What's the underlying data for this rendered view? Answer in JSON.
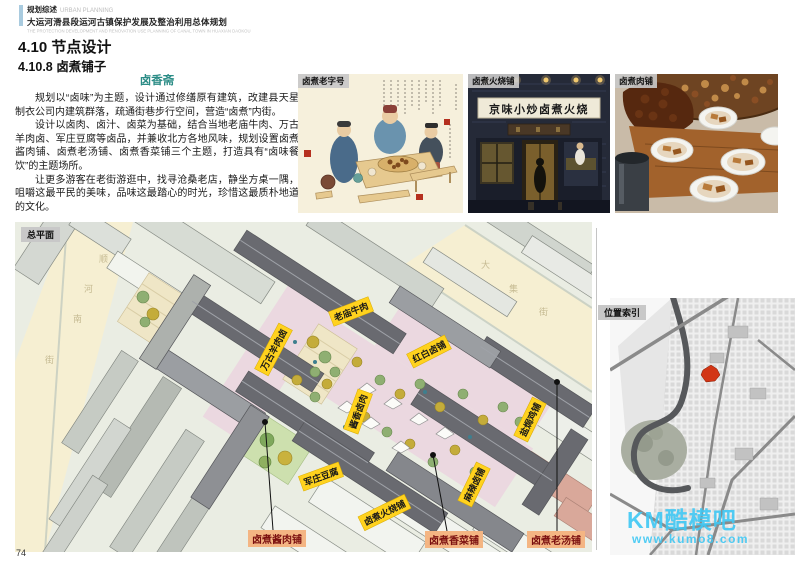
{
  "header": {
    "category_cn": "规划综述",
    "category_en": "URBAN PLANNING",
    "title_cn": "大运河滑县段运河古镇保护发展及整治利用总体规划",
    "title_en": "THE PROTECTION DEVELOPMENT AND RENOVATION USE PLANNING OF CANAL TOWN IN HUAXIAN DAOKOU",
    "accent_color": "#A9CBDF"
  },
  "section": {
    "title": "4.10 节点设计",
    "subtitle": "4.10.8 卤煮铺子"
  },
  "article": {
    "heading": "卤香斋",
    "heading_color": "#2B8C86",
    "paragraphs": [
      "规划以“卤味”为主题，设计通过修缮原有建筑，改建县天星制衣公司内建筑群落，疏通街巷步行空间，营造“卤煮”内街。",
      "设计以卤肉、卤汁、卤菜为基础，结合当地老庙牛肉、万古羊肉卤、军庄豆腐等卤品，并兼收北方各地风味，规划设置卤煮酱肉铺、卤煮老汤铺、卤煮香菜铺三个主题，打造具有“卤味餐饮”的主题场所。",
      "让更多游客在老街游逛中，找寻沧桑老店，静坐方桌一隅，咀嚼这最平民的美味，品味这最踏心的时光，珍惜这最质朴地道的文化。"
    ]
  },
  "photos": [
    {
      "label": "卤煮老字号"
    },
    {
      "label": "卤煮火烧铺",
      "sign_text": "京味小炒卤煮火烧"
    },
    {
      "label": "卤煮肉铺"
    }
  ],
  "site_plan": {
    "tag": "总平面",
    "street_left_chars": [
      "顺",
      "河",
      "南",
      "街"
    ],
    "street_right_chars": [
      "大",
      "集",
      "街"
    ],
    "shop_labels": [
      "老庙牛肉",
      "红白卤铺",
      "万古羊肉卤",
      "酱香卤肉",
      "盐焗鸡铺",
      "军庄豆腐",
      "卤煮火烧铺",
      "麻辣卤铺"
    ],
    "theme_labels": [
      "卤煮酱肉铺",
      "卤煮香菜铺",
      "卤煮老汤铺"
    ],
    "label_bg": "#FFD21E",
    "theme_bg": "#F4B583",
    "theme_text_color": "#7B1010"
  },
  "index_map": {
    "tag": "位置索引",
    "marker_color": "#D23515"
  },
  "watermark": {
    "line1": "KM酷模吧",
    "line2": "www.kumo8.com",
    "color": "#3FC8F4"
  },
  "page_number": "74"
}
